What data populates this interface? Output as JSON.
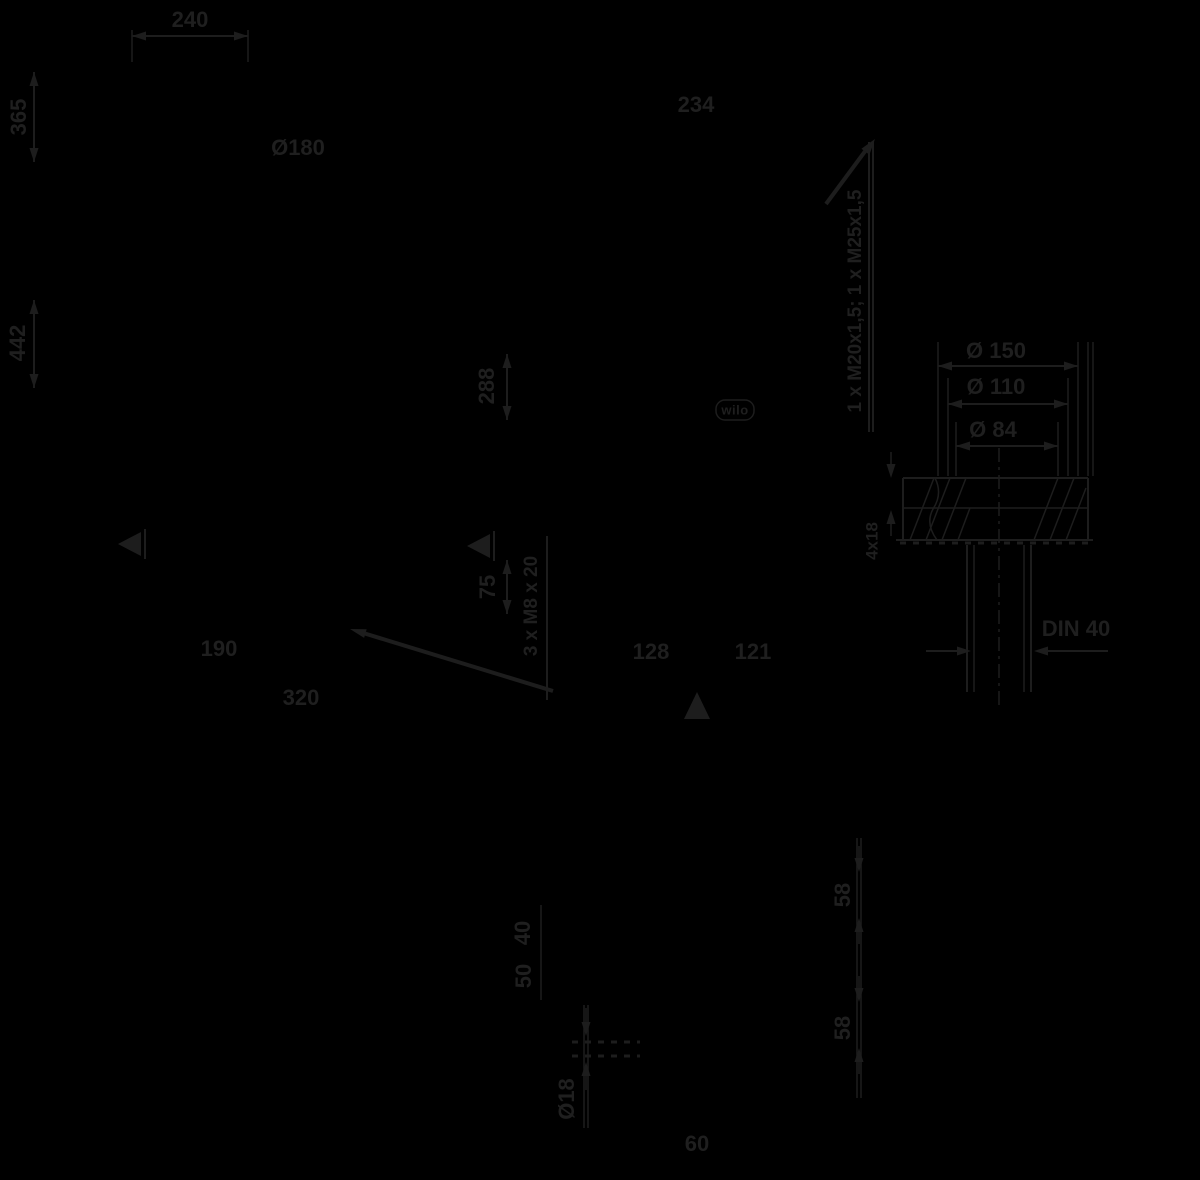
{
  "colors": {
    "background": "#000000",
    "ink": "#1d1d1d",
    "ink_text": "#1f1f1f"
  },
  "drawing": {
    "brand": "wilo",
    "labels": {
      "top_width": "240",
      "motor_diameter": "Ø180",
      "side_width": "234",
      "height_upper": "365",
      "height_total": "442",
      "height_side": "288",
      "cable_glands": "1 x M20x1,5; 1 x M25x1,5",
      "flange_outer_diameter": "Ø 150",
      "flange_bolt_circle": "Ø 110",
      "flange_inner_diameter": "Ø 84",
      "flange_holes": "4x18",
      "flange_standard": "DIN 40",
      "base_width_1": "190",
      "base_width_2": "320",
      "base_depth_1": "128",
      "base_depth_2": "121",
      "thread_spec": "3 x M8 x 20",
      "dim_75": "75",
      "dim_58_upper": "58",
      "dim_58_lower": "58",
      "dim_40": "40",
      "dim_50": "50",
      "foot_hole_diameter": "Ø18",
      "dim_60": "60"
    }
  }
}
